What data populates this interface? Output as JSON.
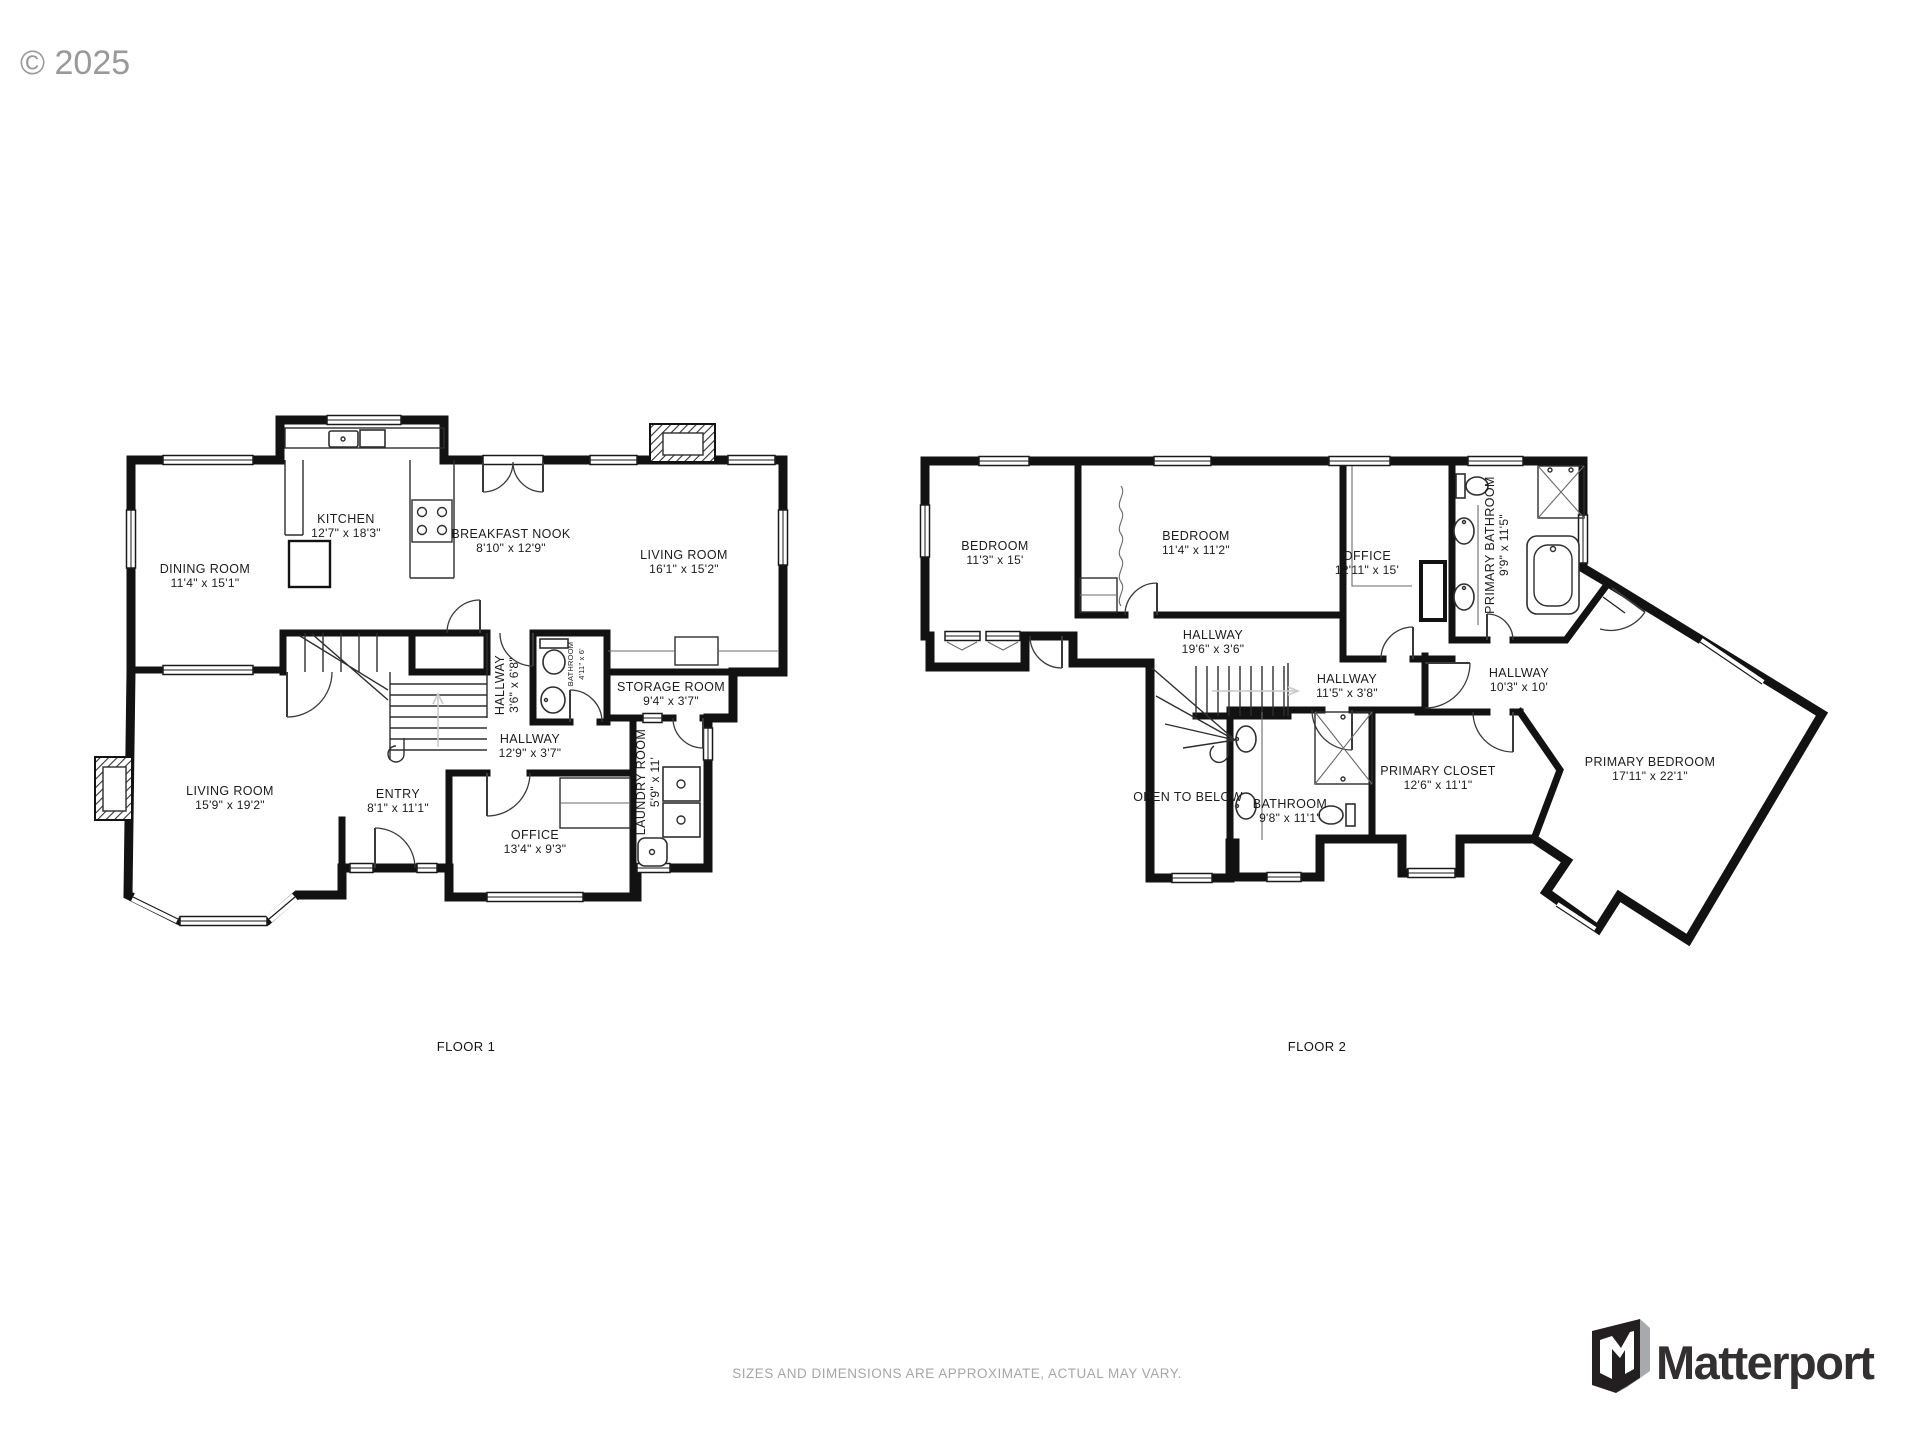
{
  "copyright": "© 2025",
  "floor1": {
    "label": "FLOOR 1",
    "rooms": [
      {
        "name": "KITCHEN",
        "dims": "12'7\" x 18'3\""
      },
      {
        "name": "BREAKFAST NOOK",
        "dims": "8'10\" x 12'9\""
      },
      {
        "name": "LIVING ROOM",
        "dims": "16'1\" x 15'2\""
      },
      {
        "name": "DINING ROOM",
        "dims": "11'4\" x 15'1\""
      },
      {
        "name": "HALLWAY",
        "dims": "3'6\" x 6'8\""
      },
      {
        "name": "BATHROOM",
        "dims": "4'11\" x 6'"
      },
      {
        "name": "STORAGE ROOM",
        "dims": "9'4\" x 3'7\""
      },
      {
        "name": "HALLWAY",
        "dims": "12'9\" x 3'7\""
      },
      {
        "name": "ENTRY",
        "dims": "8'1\" x 11'1\""
      },
      {
        "name": "LIVING ROOM",
        "dims": "15'9\" x 19'2\""
      },
      {
        "name": "OFFICE",
        "dims": "13'4\" x 9'3\""
      },
      {
        "name": "LAUNDRY ROOM",
        "dims": "5'9\" x 11'"
      }
    ]
  },
  "floor2": {
    "label": "FLOOR 2",
    "rooms": [
      {
        "name": "BEDROOM",
        "dims": "11'3\" x 15'"
      },
      {
        "name": "BEDROOM",
        "dims": "11'4\" x 11'2\""
      },
      {
        "name": "OFFICE",
        "dims": "12'11\" x 15'"
      },
      {
        "name": "PRIMARY BATHROOM",
        "dims": "9'9\" x 11'5\""
      },
      {
        "name": "HALLWAY",
        "dims": "19'6\" x 3'6\""
      },
      {
        "name": "HALLWAY",
        "dims": "11'5\" x 3'8\""
      },
      {
        "name": "HALLWAY",
        "dims": "10'3\" x 10'"
      },
      {
        "name": "OPEN TO BELOW",
        "dims": ""
      },
      {
        "name": "BATHROOM",
        "dims": "9'8\" x 11'1\""
      },
      {
        "name": "PRIMARY CLOSET",
        "dims": "12'6\" x 11'1\""
      },
      {
        "name": "PRIMARY BEDROOM",
        "dims": "17'11\" x 22'1\""
      }
    ]
  },
  "footer": {
    "disclaimer": "SIZES AND DIMENSIONS ARE APPROXIMATE, ACTUAL MAY VARY.",
    "brand": "Matterport"
  }
}
